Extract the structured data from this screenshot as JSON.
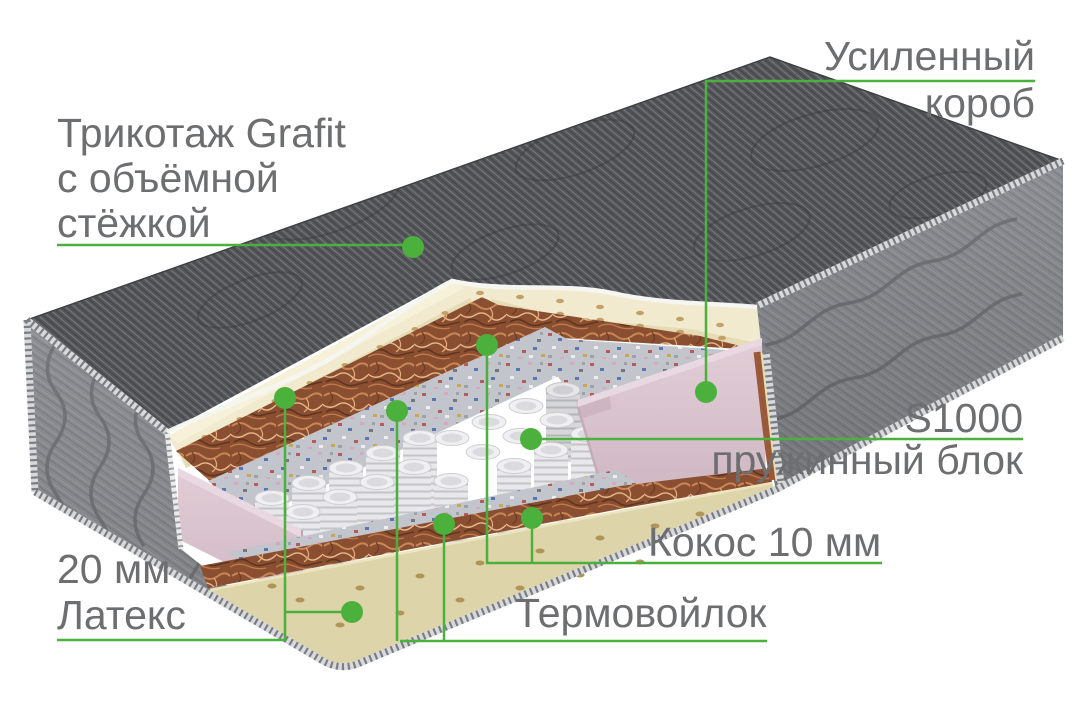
{
  "colors": {
    "accent_green": "#4bb03c",
    "label_gray": "#6d6e70",
    "cover_dark_gray": "#54565a",
    "side_gray": "#8d8f94",
    "latex_cream_top": "#f1eace",
    "latex_cream_bottom": "#ddd5a9",
    "coconut_brown": "#9a5a3a",
    "felt_multicolor_base": "#c3c5cc",
    "spring_white": "#e9e9eb",
    "foam_pink": "#d9c4ce"
  },
  "callouts": {
    "fabric": {
      "lines": [
        "Трикотаж Grafit",
        "с объёмной",
        "стёжкой"
      ]
    },
    "box": {
      "lines": [
        "Усиленный",
        "короб"
      ]
    },
    "springs": {
      "code": "S1000",
      "name": "пружинный блок"
    },
    "coconut": {
      "text": "Кокос 10 мм"
    },
    "felt": {
      "text": "Термовойлок"
    },
    "latex": {
      "thickness": "20 мм",
      "name": "Латекс"
    }
  },
  "layers_depicted": [
    "Трикотаж Grafit с объёмной стёжкой",
    "Латекс 20 мм",
    "Кокос 10 мм",
    "Термовойлок",
    "Пружинный блок S1000",
    "Усиленный короб"
  ]
}
